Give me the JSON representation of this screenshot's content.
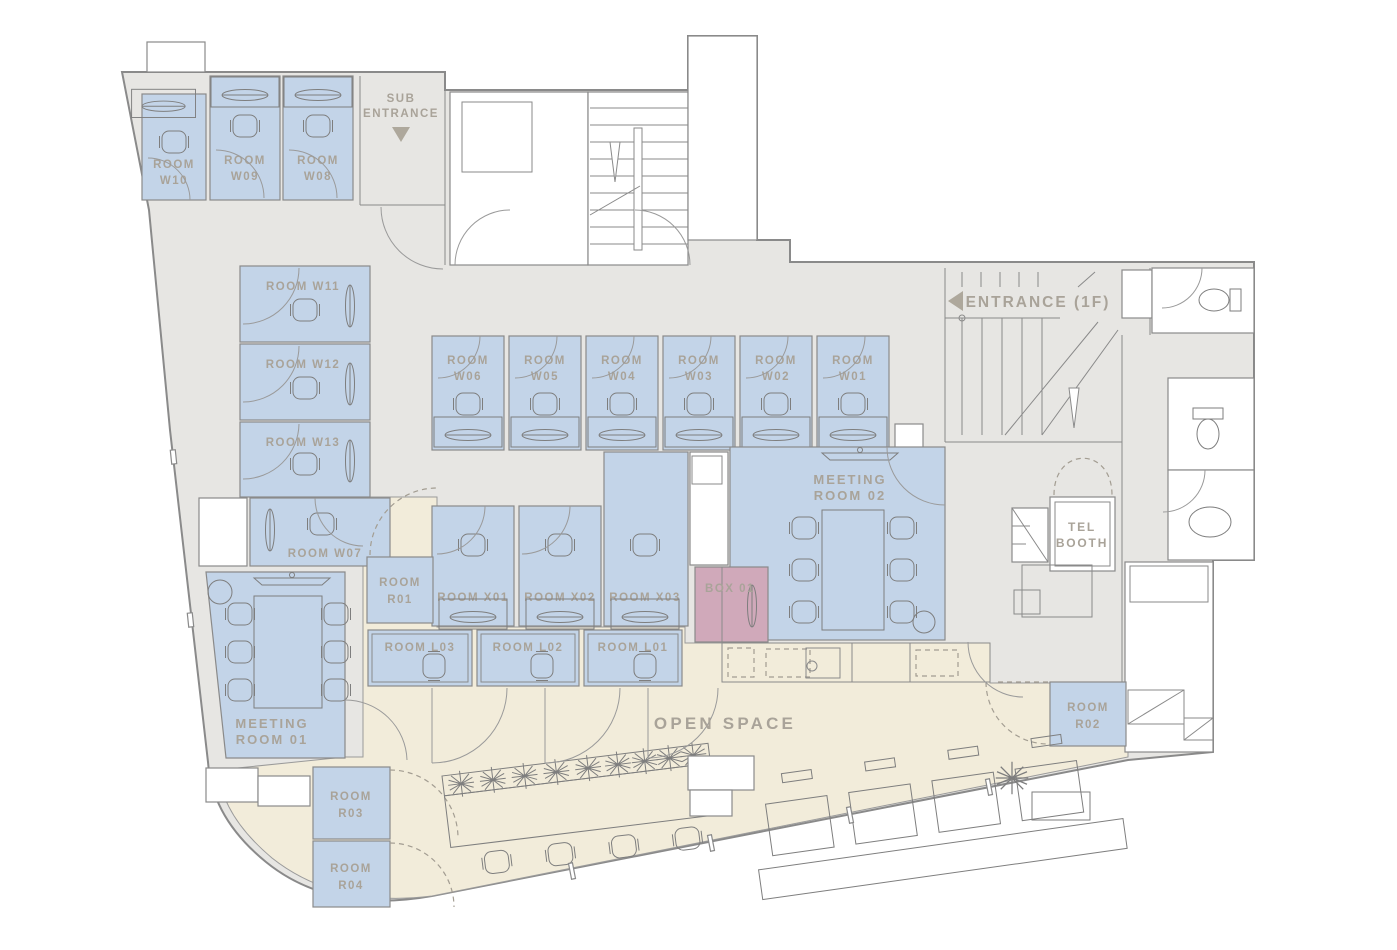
{
  "palette": {
    "room_fill": "#c3d4e8",
    "phone_box_fill": "#d0a9ba",
    "open_space_fill": "#f2ecda",
    "corridor_fill": "#e7e6e3",
    "wall_line": "#8a8a8a",
    "label_text": "#a9a399"
  },
  "entrances": {
    "sub": {
      "line1": "SUB",
      "line2": "ENTRANCE",
      "arrow": "down"
    },
    "main": {
      "label": "ENTRANCE (1F)",
      "arrow": "left"
    }
  },
  "areas": {
    "open_space": {
      "label": "OPEN SPACE"
    },
    "tel_booth": {
      "line1": "TEL",
      "line2": "BOOTH"
    },
    "box01": {
      "label": "BOX 01"
    },
    "meeting01": {
      "line1": "MEETING",
      "line2": "ROOM 01"
    },
    "meeting02": {
      "line1": "MEETING",
      "line2": "ROOM 02"
    }
  },
  "rooms": {
    "w01": {
      "line1": "ROOM",
      "line2": "W01"
    },
    "w02": {
      "line1": "ROOM",
      "line2": "W02"
    },
    "w03": {
      "line1": "ROOM",
      "line2": "W03"
    },
    "w04": {
      "line1": "ROOM",
      "line2": "W04"
    },
    "w05": {
      "line1": "ROOM",
      "line2": "W05"
    },
    "w06": {
      "line1": "ROOM",
      "line2": "W06"
    },
    "w07": {
      "label": "ROOM W07"
    },
    "w08": {
      "line1": "ROOM",
      "line2": "W08"
    },
    "w09": {
      "line1": "ROOM",
      "line2": "W09"
    },
    "w10": {
      "line1": "ROOM",
      "line2": "W10"
    },
    "w11": {
      "label": "ROOM W11"
    },
    "w12": {
      "label": "ROOM W12"
    },
    "w13": {
      "label": "ROOM W13"
    },
    "x01": {
      "label": "ROOM X01"
    },
    "x02": {
      "label": "ROOM X02"
    },
    "x03": {
      "label": "ROOM X03"
    },
    "l01": {
      "label": "ROOM L01"
    },
    "l02": {
      "label": "ROOM L02"
    },
    "l03": {
      "label": "ROOM L03"
    },
    "r01": {
      "line1": "ROOM",
      "line2": "R01"
    },
    "r02": {
      "line1": "ROOM",
      "line2": "R02"
    },
    "r03": {
      "line1": "ROOM",
      "line2": "R03"
    },
    "r04": {
      "line1": "ROOM",
      "line2": "R04"
    }
  }
}
